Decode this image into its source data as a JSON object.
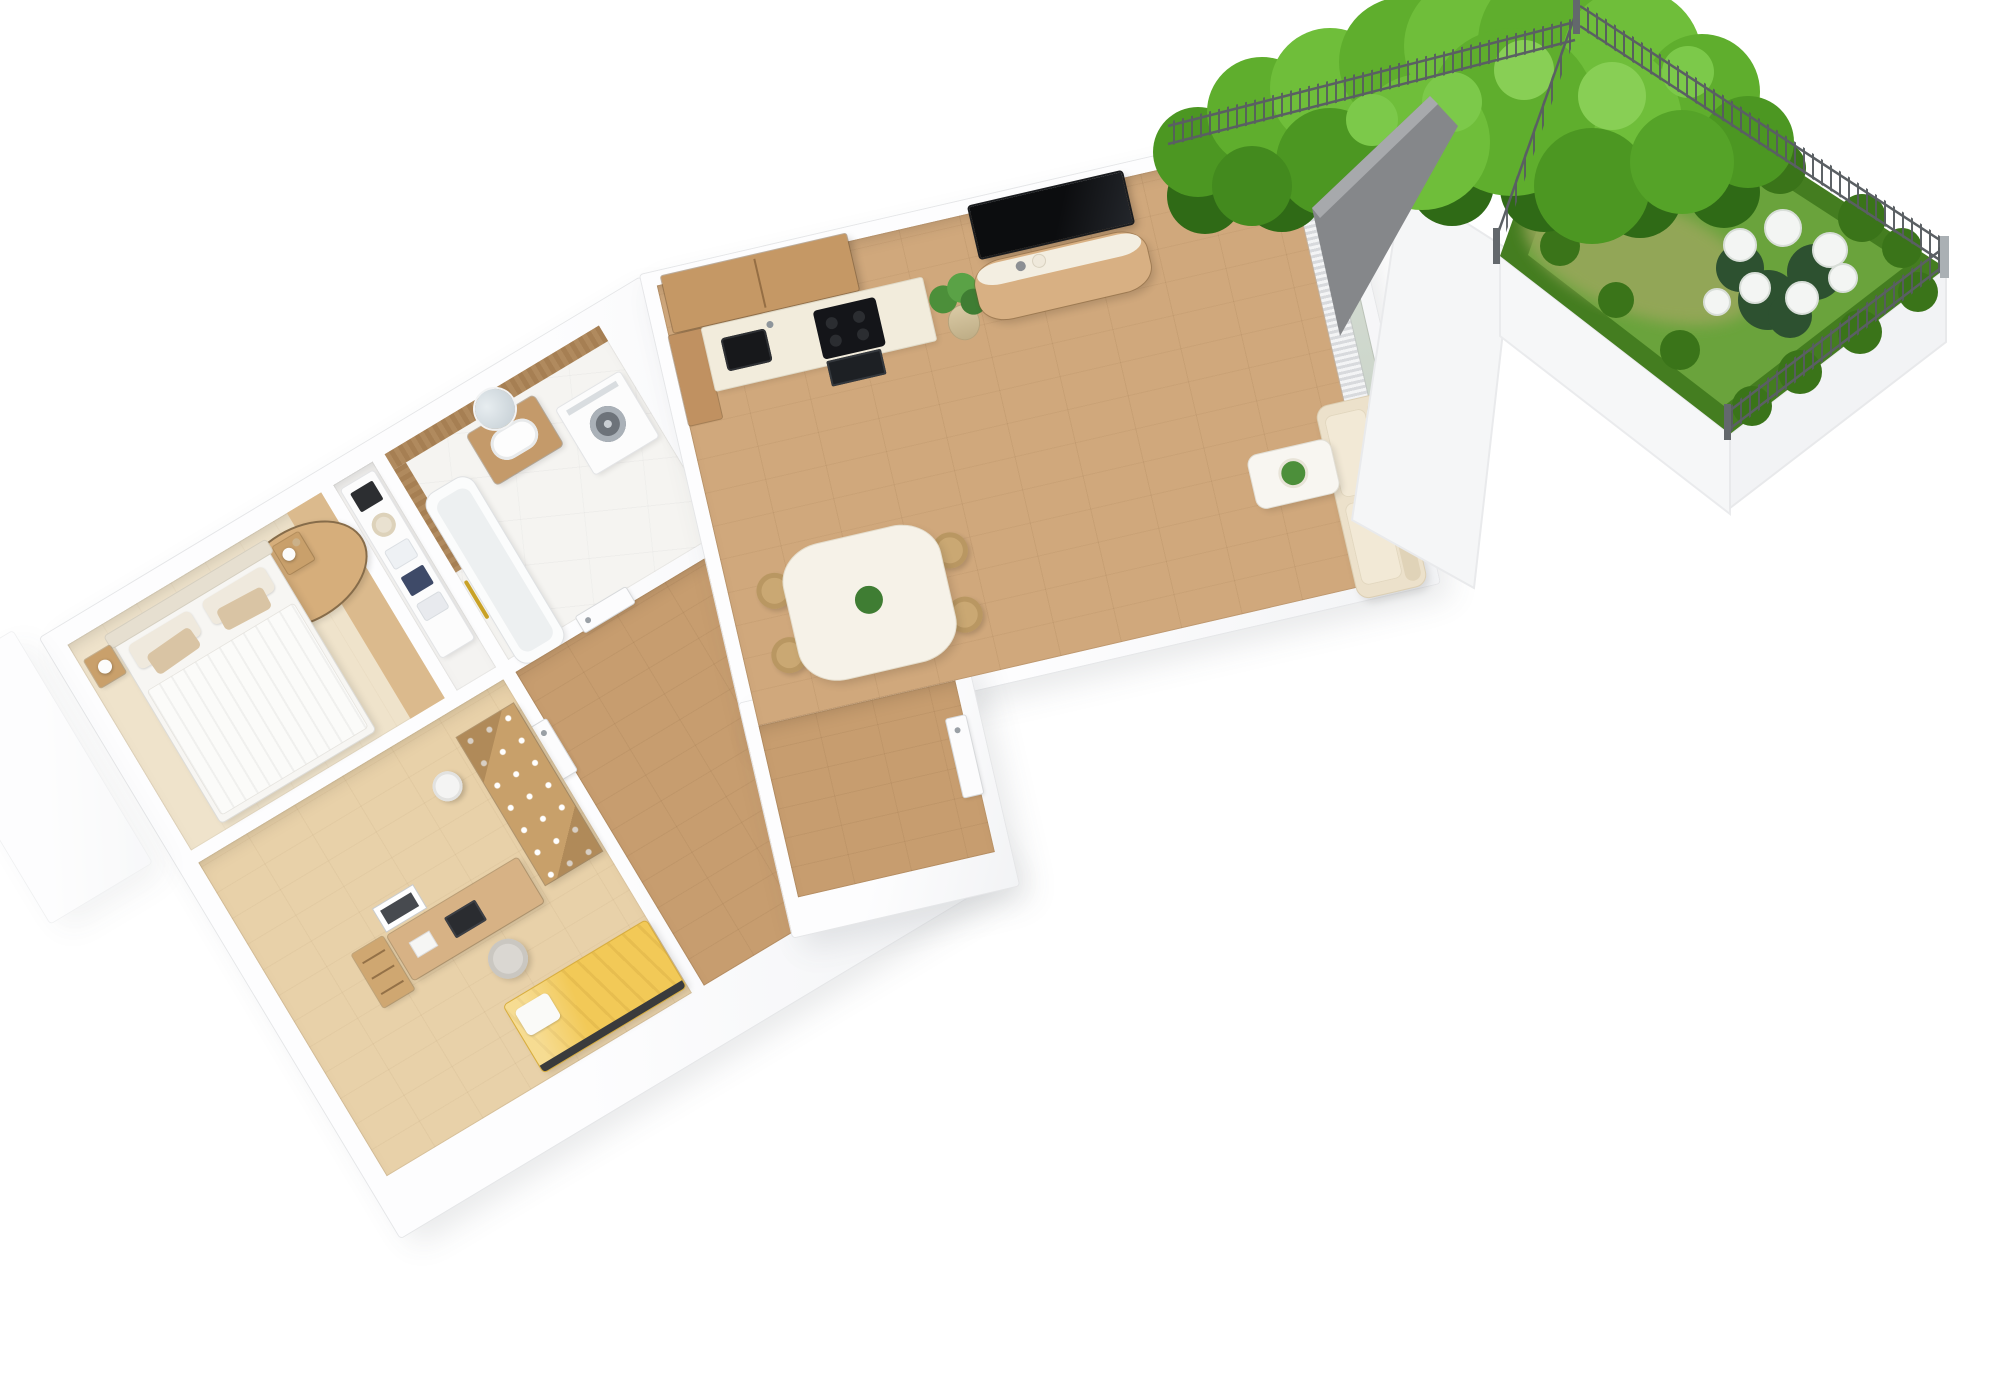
{
  "meta": {
    "kind": "3D floor plan rendering",
    "view": "rotated axonometric top view",
    "visible_text": "none"
  },
  "palette": {
    "background": "#ffffff",
    "wall": "#fbfcfd",
    "wall_edge": "#e5e6e8",
    "living_floor": "#d0a87c",
    "kids_floor": "#e8d1a9",
    "hall_floor": "#c79d6f",
    "bedroom_carpet": "#efe3cb",
    "marble": "#f5f4f1",
    "cabinet_wood": "#c59865",
    "counter_cream": "#f2ecdc",
    "appliance_black": "#17181b",
    "sofa_beige": "#ece1cb",
    "rug_tan": "#d6ae7b",
    "kids_blanket_yellow": "#f2c957",
    "plant_green": "#4c8f3a",
    "grass": "#6aa33c",
    "hedge": "#447d20",
    "tree_foliage": "#5fae2d",
    "fence_gray": "#5a5f63",
    "privacy_panel_gray": "#85878a",
    "gold_accent": "#c9a227",
    "navy": "#3e4a68"
  },
  "rooms": {
    "bedroom": {
      "label": "Bedroom"
    },
    "closet": {
      "label": "Walk-in closet"
    },
    "kids_room": {
      "label": "Kids room"
    },
    "bathroom": {
      "label": "Bathroom"
    },
    "hallway": {
      "label": "Hallway"
    },
    "wc": {
      "label": "Toilet room"
    },
    "kitchen": {
      "label": "Kitchen"
    },
    "living": {
      "label": "Living room"
    },
    "dining": {
      "label": "Dining area"
    },
    "entry": {
      "label": "Entry vestibule"
    },
    "garden": {
      "label": "Garden terrace"
    }
  },
  "furniture": {
    "double_bed": "Double bed",
    "headboard": "Headboard",
    "pillows": "Pillows",
    "nightstand_left": "Nightstand with lamp",
    "nightstand_right": "Nightstand with lamp and vase",
    "round_rug": "Round rug",
    "closet_shelves": "Closet shelving with boxes and towels",
    "bathtub": "Bathtub",
    "vanity": "Vanity with sink",
    "round_mirror": "Round mirror",
    "washing_machine": "Washing machine",
    "towel_rail": "Gold towel rail",
    "toilet": "Toilet",
    "shoe_bench": "Shoe bench with storage boxes",
    "bath_door": "Bathroom door",
    "kids_door": "Kids room door",
    "wc_door": "Toilet door",
    "entrance_door": "Entrance door",
    "desk": "Desk",
    "laptop": "Laptop",
    "desk_chair": "Desk chair",
    "drawer_unit": "Drawer unit",
    "poster_frame": "Poster frame",
    "climbing_wardrobe": "Wardrobe with climbing holds",
    "stool": "Stool",
    "kids_bed": "Kids bed with yellow blanket",
    "upper_cabinets": "Upper kitchen cabinets",
    "tall_cabinet": "Tall kitchen cabinet",
    "countertop": "Countertop",
    "kitchen_sink": "Kitchen sink",
    "cooktop": "Cooktop",
    "oven": "Oven",
    "potted_plant": "Potted plant",
    "tv": "Wall-mounted TV",
    "sideboard": "Sideboard",
    "sofa": "Sofa",
    "coffee_table": "Coffee table with plant",
    "curtains": "Curtains",
    "glass_door": "Sliding glass door",
    "dining_table": "Dining table",
    "dining_chair": "Dining chair",
    "table_plant": "Table plant"
  },
  "dining_chair_count": 4,
  "garden": {
    "label": "Garden terrace",
    "lawn": "Lawn",
    "hedge": "Hedge",
    "tree": "Garden tree",
    "flowers": "White hydrangeas",
    "flower_count": 7,
    "fence": "Wire mesh fence",
    "fence_sides": [
      "top",
      "left",
      "right"
    ],
    "privacy_panel": "Gray privacy panel",
    "boundary_wall": "White boundary wall"
  }
}
